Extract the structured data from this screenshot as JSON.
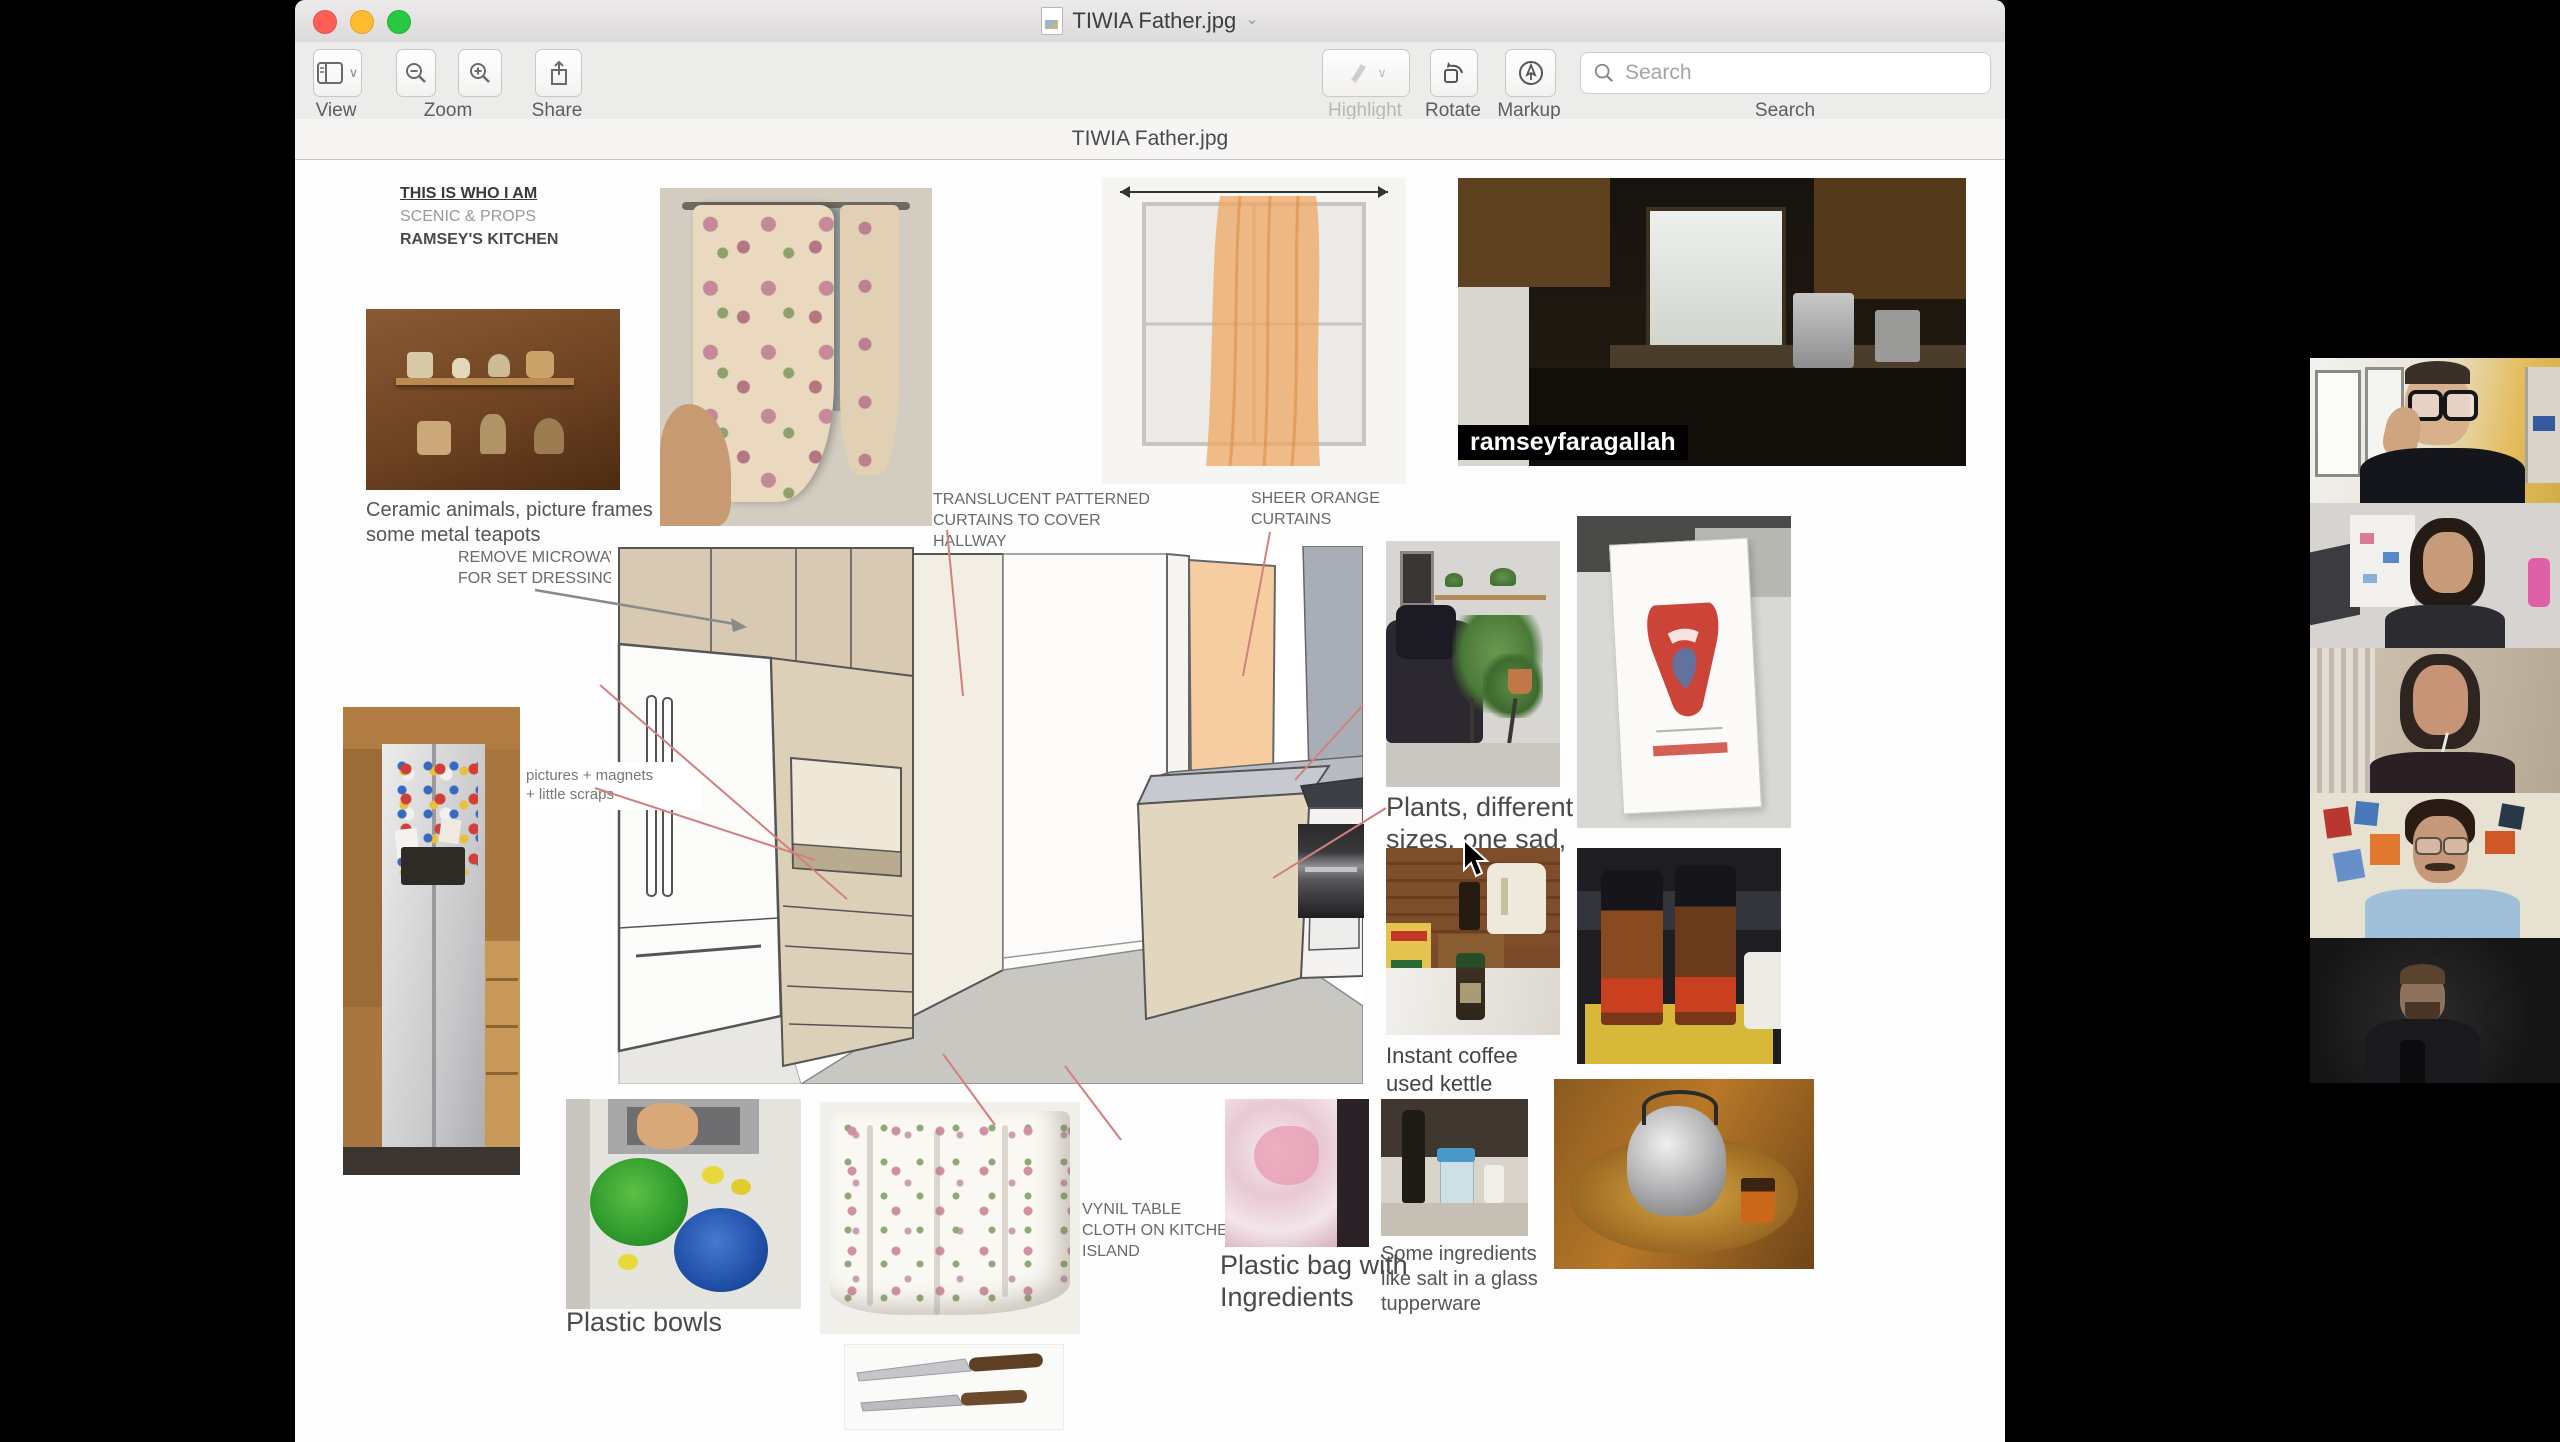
{
  "window": {
    "title": "TIWIA Father.jpg",
    "filename_bar": "TIWIA Father.jpg",
    "toolbar": {
      "view": "View",
      "zoom": "Zoom",
      "share": "Share",
      "highlight": "Highlight",
      "rotate": "Rotate",
      "markup": "Markup",
      "search_label": "Search",
      "search_placeholder": "Search"
    }
  },
  "document": {
    "header": {
      "line1": "THIS IS WHO I AM",
      "line2": "SCENIC & PROPS",
      "line3": "RAMSEY'S KITCHEN"
    },
    "captions": {
      "ceramic": "Ceramic animals, picture frames\nsome metal teapots",
      "translucent": "TRANSLUCENT PATTERNED\nCURTAINS TO COVER\nHALLWAY",
      "sheer": "SHEER ORANGE\nCURTAINS",
      "remove_microwave": "REMOVE MICROWAVE\nFOR SET DRESSING",
      "magnets": "pictures + magnets\n+ little scraps",
      "plants": "Plants, different\nsizes, one sad,",
      "instant_coffee": "Instant coffee\nused kettle",
      "vynil": "VYNIL TABLE\nCLOTH ON KITCHEN\nISLAND",
      "plastic_bag": "Plastic bag with\nIngredients",
      "ingredients": "Some ingredients\nlike salt in a glass\ntupperware",
      "plastic_bowls": "Plastic bowls",
      "video_name_tag": "ramseyfaragallah"
    }
  },
  "colors": {
    "annotation_pink": "#d27f7f",
    "traffic_red": "#ff5f57",
    "traffic_yellow": "#febc2e",
    "traffic_green": "#28c840",
    "sketch_cabinet_tan": "#d8cab2",
    "sketch_door_peach": "#f5cda1"
  }
}
